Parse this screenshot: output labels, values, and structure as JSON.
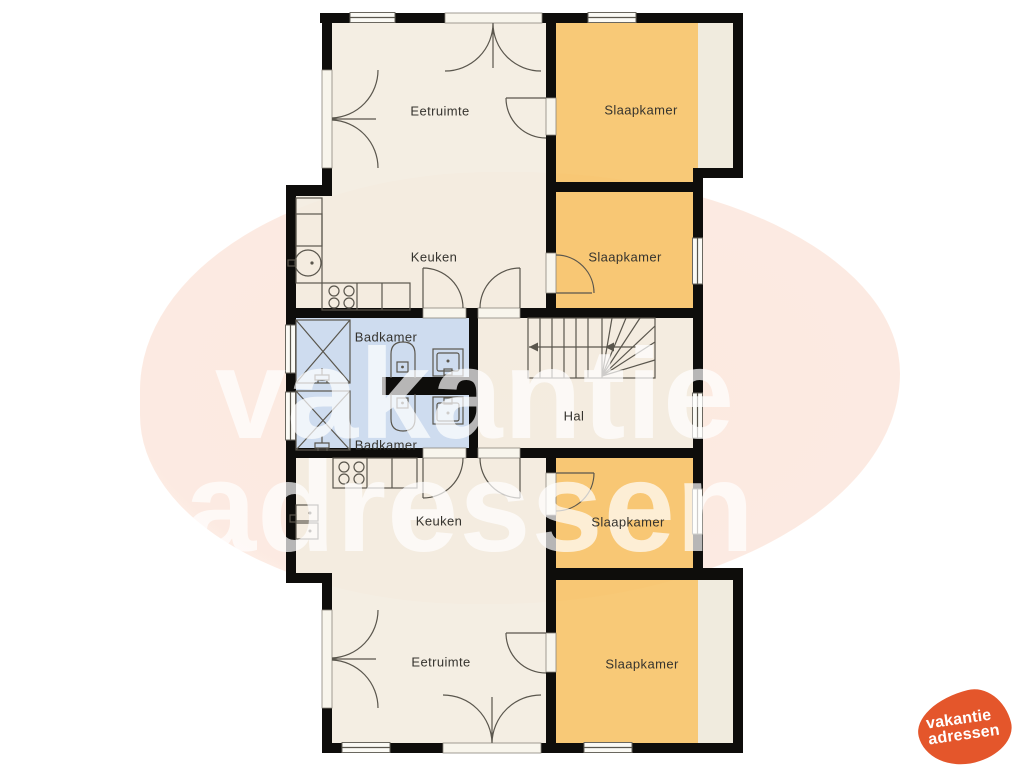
{
  "floorplan": {
    "rooms": [
      {
        "id": "eetruimte-top",
        "label": "Eetruimte",
        "color": "#f2ecdf"
      },
      {
        "id": "slaapkamer-top-right",
        "label": "Slaapkamer",
        "color": "#f7c264"
      },
      {
        "id": "keuken-top",
        "label": "Keuken",
        "color": "#f2ecdf"
      },
      {
        "id": "slaapkamer-mid-right",
        "label": "Slaapkamer",
        "color": "#f7c264"
      },
      {
        "id": "badkamer-upper",
        "label": "Badkamer",
        "color": "#c7daf0"
      },
      {
        "id": "badkamer-lower",
        "label": "Badkamer",
        "color": "#c7daf0"
      },
      {
        "id": "hal",
        "label": "Hal",
        "color": "#f2ecdf"
      },
      {
        "id": "keuken-bottom",
        "label": "Keuken",
        "color": "#f2ecdf"
      },
      {
        "id": "slaapkamer-lower-right",
        "label": "Slaapkamer",
        "color": "#f7c264"
      },
      {
        "id": "eetruimte-bottom",
        "label": "Eetruimte",
        "color": "#f2ecdf"
      },
      {
        "id": "slaapkamer-bottom-right",
        "label": "Slaapkamer",
        "color": "#f7c264"
      }
    ]
  },
  "watermark": {
    "line1": "vakantie",
    "line2": "adressen",
    "color": "#ffffff",
    "blob_tint": "#fad6c5"
  },
  "logo": {
    "line1": "vakantie",
    "line2": "adressen"
  },
  "colors": {
    "wall": "#0e0d0b",
    "floor-cream": "#f2ecdf",
    "floor-orange": "#f7c264",
    "floor-blue": "#c7daf0",
    "floor-strip": "#eee8d9",
    "line": "#5a564d",
    "label": "#35332e",
    "logo-orange": "#e4562b"
  }
}
